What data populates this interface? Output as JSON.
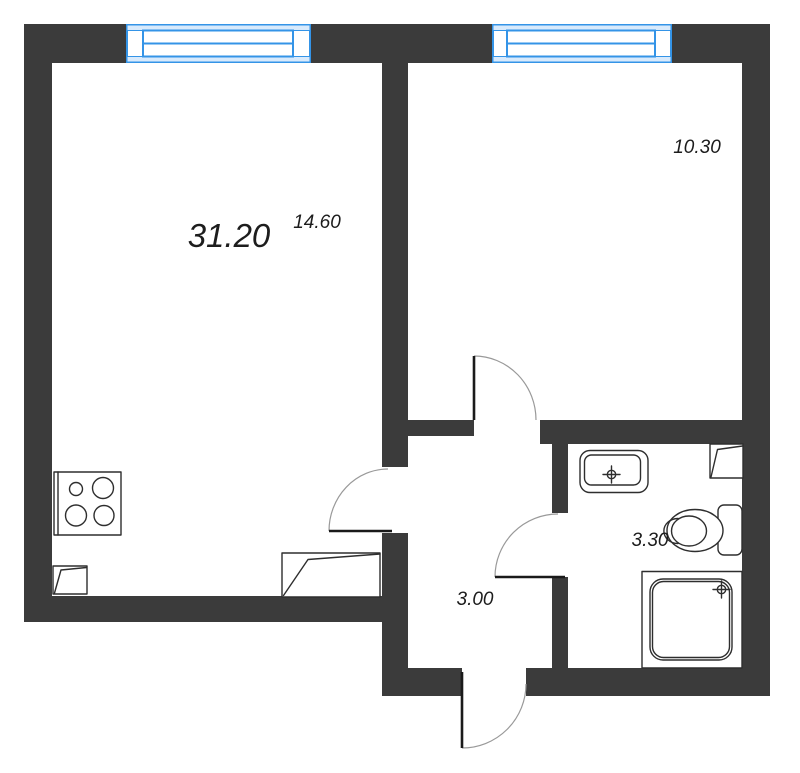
{
  "plan": {
    "labels": {
      "living_area": "31.20",
      "living_sub_area": "14.60",
      "bedroom_area": "10.30",
      "bathroom_area": "3.30",
      "hallway_area": "3.00"
    },
    "fixtures": [
      "window",
      "door",
      "stove",
      "sink",
      "toilet",
      "shower",
      "vent-unit"
    ],
    "colors": {
      "wall": "#3b3b3b",
      "window_stroke": "#3494e7",
      "window_fill": "#d8eafc",
      "fixture_stroke": "#2e2e2e",
      "door_leaf": "#1a1a1a",
      "door_arc": "#999999",
      "label": "#1d1d1d",
      "background": "#ffffff"
    }
  }
}
